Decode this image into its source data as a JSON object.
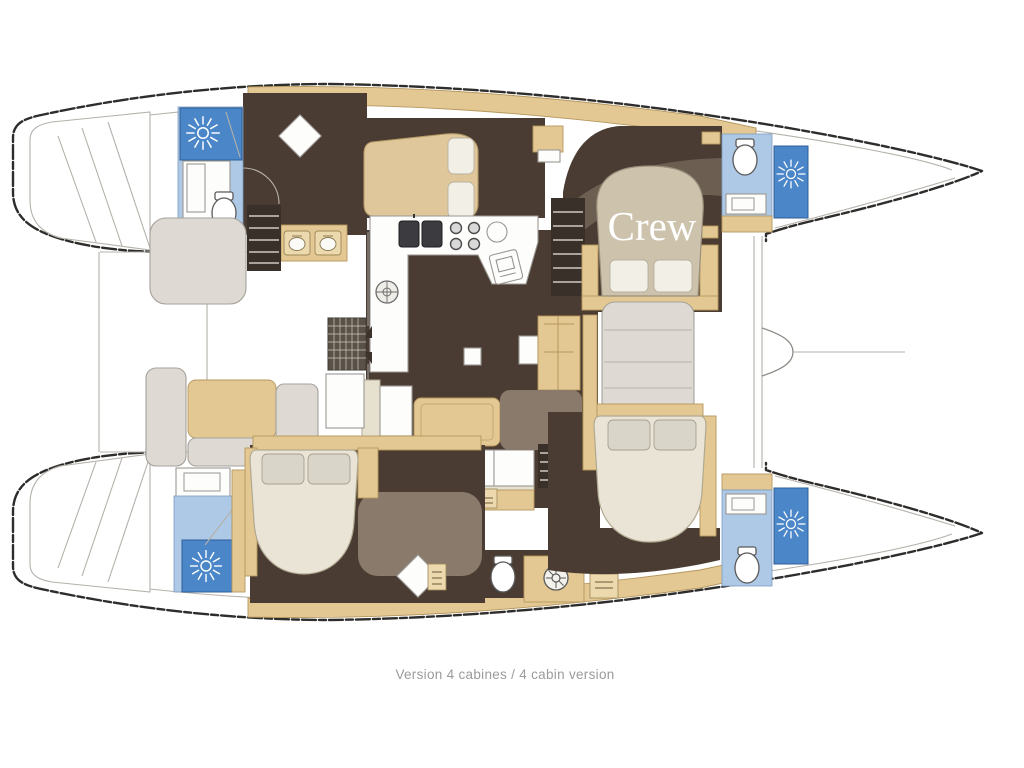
{
  "caption": "Version 4 cabines / 4 cabin version",
  "labels": {
    "crew": "Crew"
  },
  "icons": {
    "shower": "white sunburst on blue shower pan",
    "toilet": "white oval wc",
    "stove": "four burner circles",
    "galley_sink": "double dark sink",
    "stairs": "dark treads",
    "drain": "round shower drain wheel",
    "hatch": "round deck hatch"
  },
  "colors": {
    "hull_stroke": "#2e2d2b",
    "line_gray": "#b5b1aa",
    "wood": "#e3c893",
    "wood_dark": "#b6975e",
    "wood_light": "#ecd9ad",
    "floor_dark": "#4a3c33",
    "floor_taupe": "#8a7a6b",
    "bath_light": "#aec9e6",
    "bath_dark": "#4a86c8",
    "seat_gray": "#deDAD3",
    "bed_cream": "#e9e4d6",
    "pillow_gray": "#d9d5c8",
    "crew_text": "#ffffff",
    "caption": "#9b9b9b"
  }
}
